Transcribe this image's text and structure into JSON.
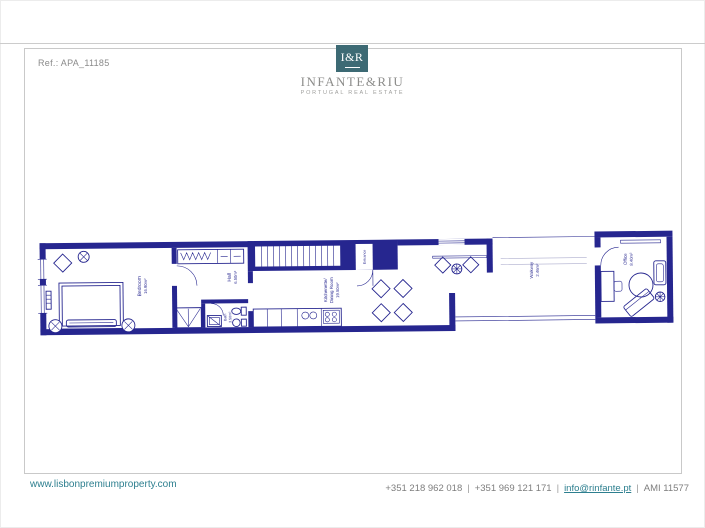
{
  "header": {
    "ref": "Ref.: APA_11185",
    "logo_monogram": "I&R",
    "logo_name": "INFANTE&RIU",
    "logo_tagline": "PORTUGAL REAL ESTATE"
  },
  "floorplan": {
    "rooms": {
      "bedroom": {
        "label": "Bedroom",
        "area": "16.90m²"
      },
      "hall": {
        "label": "Hall",
        "area": "6.50m²"
      },
      "bath": {
        "label": "Bath",
        "area": "3.50m²"
      },
      "kitchenette": {
        "line1": "Kitchenette/",
        "line2": "Dining Room",
        "area": "19.50m²"
      },
      "entrance": {
        "label": "Entrance"
      },
      "walkway": {
        "label": "Walkway",
        "area": "2.46m²"
      },
      "office": {
        "label": "Office",
        "area": "8.40m²"
      }
    }
  },
  "footer": {
    "website": "www.lisbonpremiumproperty.com",
    "phone1": "+351 218 962 018",
    "sep1": "|",
    "phone2": "+351 969 121 171",
    "sep2": "|",
    "email": "info@rinfante.pt",
    "sep3": "|",
    "license": "AMI 11577"
  },
  "colors": {
    "wall": "#26268f",
    "brand": "#3d6a74",
    "link": "#2d7f8f",
    "muted": "#8a8a8a"
  }
}
